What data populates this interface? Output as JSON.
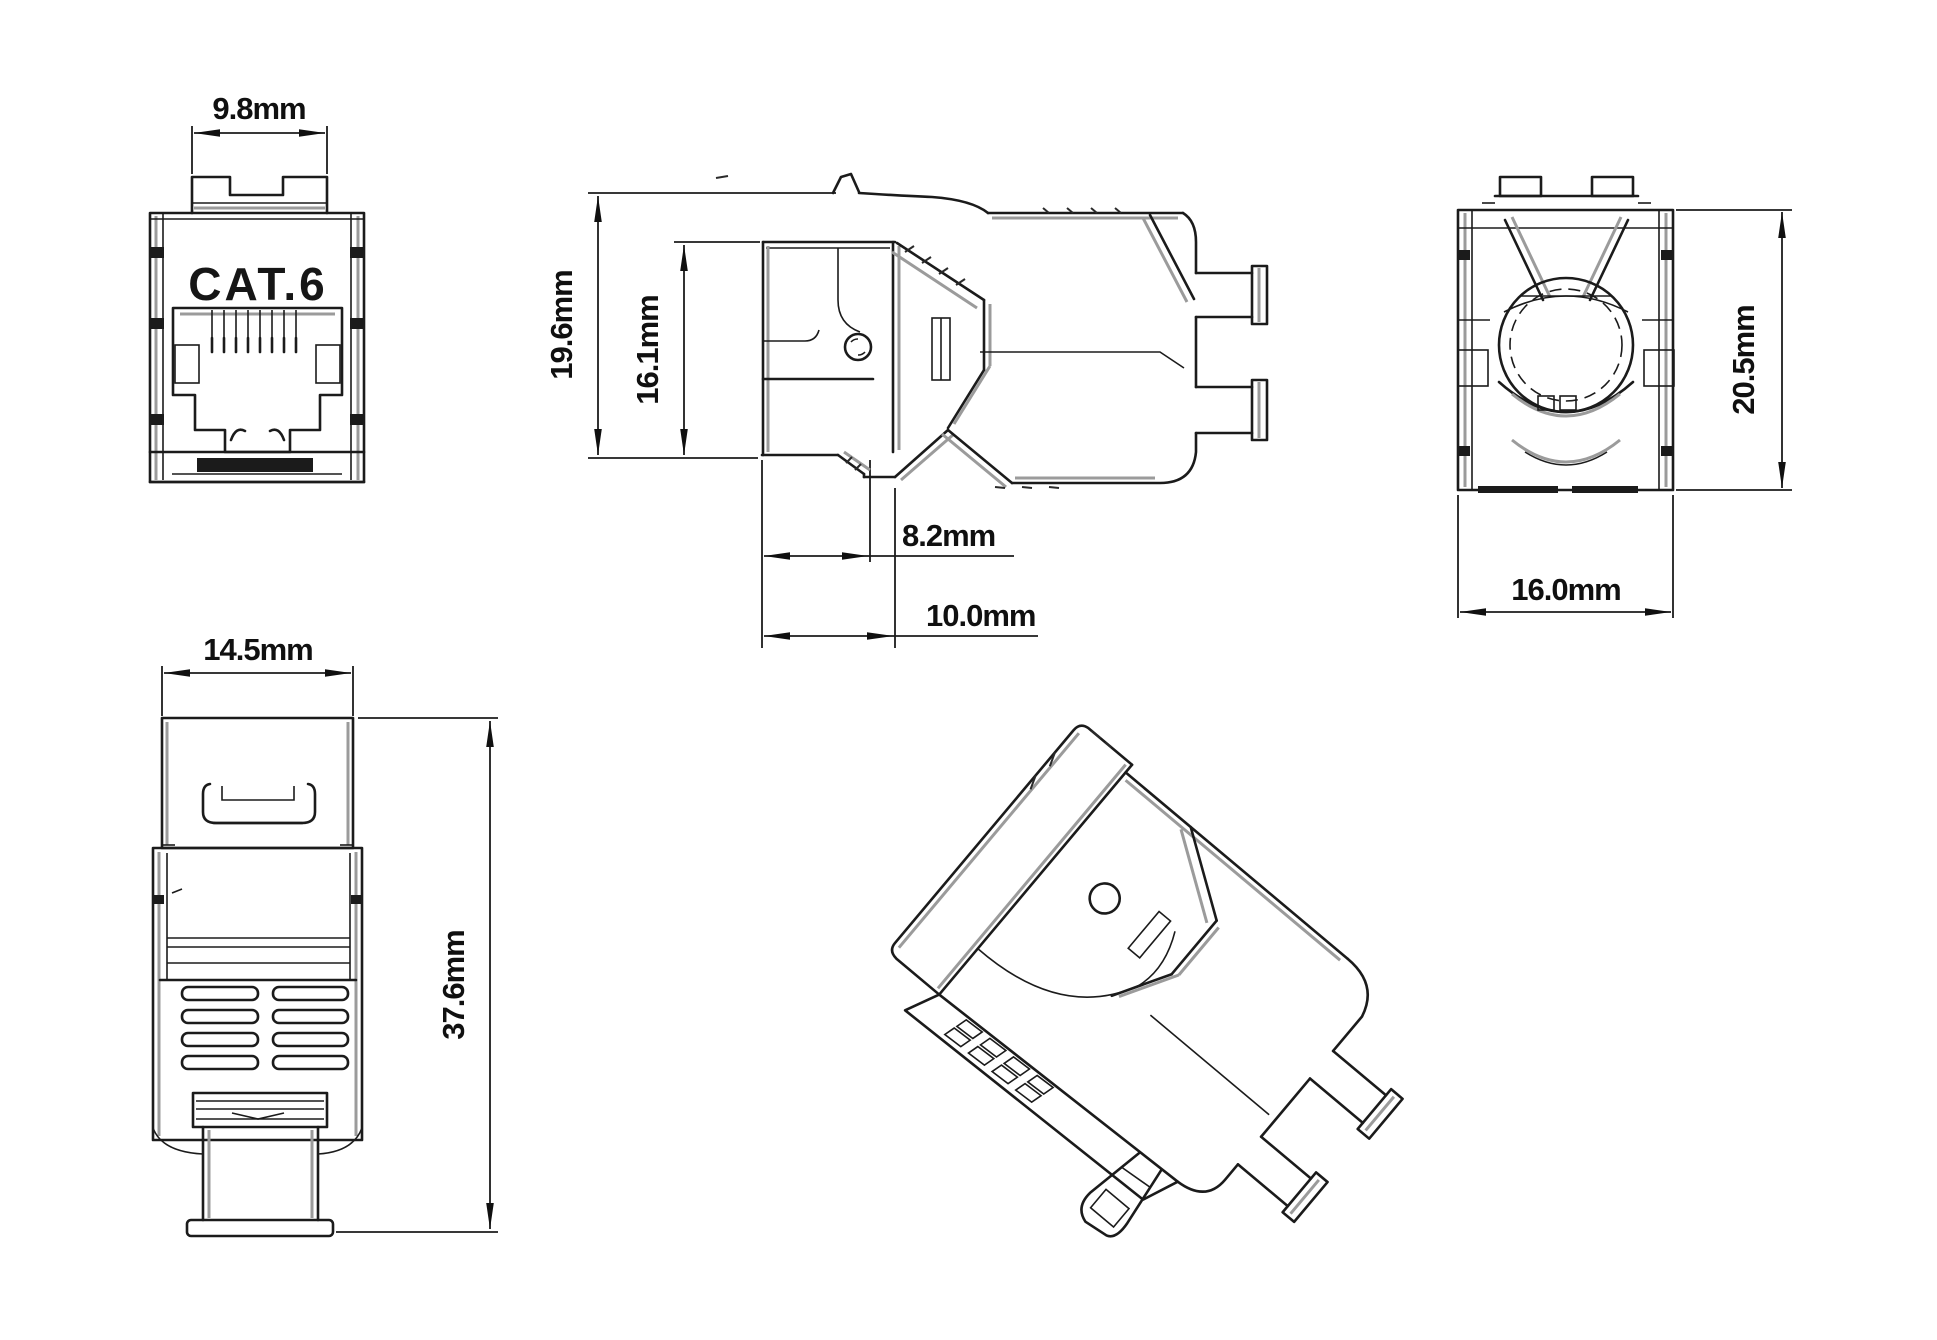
{
  "colors": {
    "background": "#ffffff",
    "line": "#1b1b1b",
    "secondary_edge": "#9b9b9b",
    "text": "#101010"
  },
  "views": {
    "front": {
      "product_marking": "CAT.6",
      "dim_slot_width": "9.8mm"
    },
    "side": {
      "dim_overall_height": "19.6mm",
      "dim_body_height": "16.1mm",
      "dim_latch_depth": "8.2mm",
      "dim_front_depth": "10.0mm"
    },
    "rear": {
      "dim_height": "20.5mm",
      "dim_width": "16.0mm"
    },
    "top": {
      "dim_width": "14.5mm",
      "dim_overall_length": "37.6mm"
    }
  }
}
